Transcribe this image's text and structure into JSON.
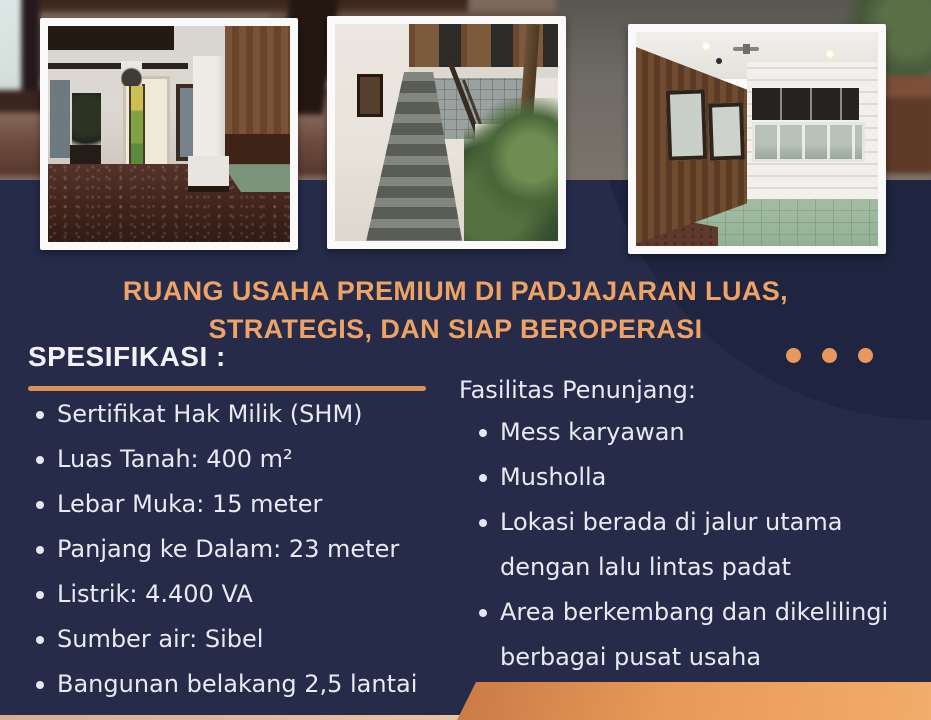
{
  "title": {
    "lines": [
      "RUANG USAHA PREMIUM DI PADJAJARAN LUAS,",
      "STRATEGIS, DAN SIAP BEROPERASI"
    ]
  },
  "spec": {
    "heading": "SPESIFIKASI :",
    "items": [
      "Sertifikat Hak Milik (SHM)",
      "Luas Tanah: 400 m²",
      "Lebar Muka: 15 meter",
      "Panjang ke Dalam: 23 meter",
      "Listrik: 4.400 VA",
      "Sumber air: Sibel",
      "Bangunan belakang 2,5 lantai"
    ]
  },
  "fasilitas": {
    "heading": "Fasilitas Penunjang:",
    "items": [
      [
        "Mess karyawan"
      ],
      [
        "Musholla"
      ],
      [
        "Lokasi berada di jalur utama",
        "dengan lalu lintas padat"
      ],
      [
        "Area berkembang dan dikelilingi",
        "berbagai pusat usaha"
      ]
    ]
  },
  "decor": {
    "dots_count": 3
  },
  "photos": [
    {
      "name": "lobby-interior-photo"
    },
    {
      "name": "staircase-photo"
    },
    {
      "name": "wood-paneled-room-photo"
    }
  ],
  "colors": {
    "background_navy": "#252b49",
    "circle_navy_dark": "#1f2440",
    "title_orange": "#eda266",
    "underline_orange": "#da8f58",
    "dot_orange": "#e8985c",
    "body_text": "#e9e9f2",
    "bottom_shape_orange": "#e89a58",
    "bottom_strip_tan": "#dcb49b"
  }
}
